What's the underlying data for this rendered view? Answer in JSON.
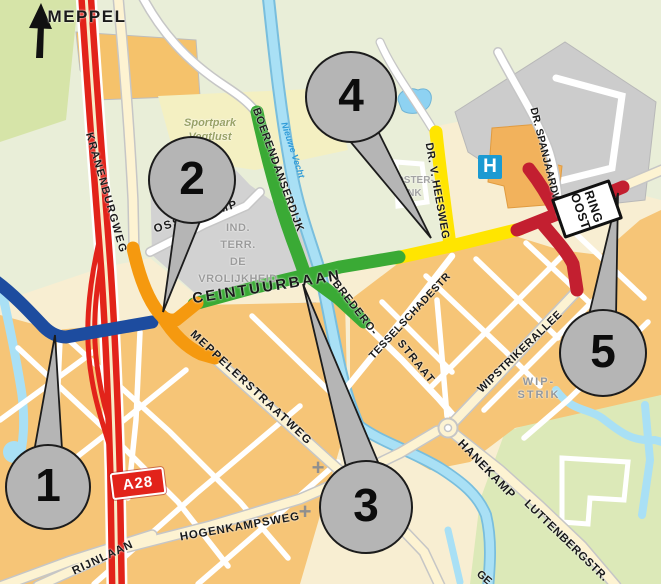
{
  "title": {
    "destination": "MEPPEL"
  },
  "street_labels": {
    "kranenburgweg": "KRANENBURGWEG",
    "ossenkamp": "OSSENKAMP",
    "boerendanserdijk": "BOERENDANSERDIJK",
    "ceintuurbaan": "CEINTUURBAAN",
    "bredero": "BREDERO-",
    "bredero_straat": "STRAAT",
    "tesselschadestr": "TESSELSCHADESTR",
    "dr_v_heesweg": "DR. V. HEESWEG",
    "dr_spanjaardweg": "DR. SPANJAARDWEG",
    "wipstrikerallee": "WIPSTRIKERALLEE",
    "meppelerstraatweg": "MEPPELERSTRAATWEG",
    "hogenkampsweg": "HOGENKAMPSWEG",
    "rijnlaan": "RIJNLAAN",
    "hanekamp": "HANEKAMP",
    "luttenbergstr": "LUTTENBERGSTR.",
    "partial_bottom": "GE"
  },
  "area_labels": {
    "sportpark_line1": "Sportpark",
    "sportpark_line2": "Vegtlust",
    "ind_terr_line1": "IND.",
    "ind_terr_line2": "TERR.",
    "ind_terr_line3": "DE",
    "ind_terr_line4": "VROLIJKHEID",
    "ooster_line1": "OOSTER-",
    "ooster_line2": "ENK",
    "wip_line1": "WIP-",
    "wip_line2": "STRIK",
    "water_nieuwe_vecht": "Nieuwe Vecht"
  },
  "badges": {
    "motorway": "A28",
    "ring_line1": "RING",
    "ring_line2": "OOST",
    "hospital": "H"
  },
  "markers": [
    {
      "number": "1"
    },
    {
      "number": "2"
    },
    {
      "number": "3"
    },
    {
      "number": "4"
    },
    {
      "number": "5"
    }
  ],
  "icons": {
    "church_cross": "+"
  },
  "colors": {
    "segment_1_blue": "#1d4c9f",
    "segment_2_orange": "#f5990f",
    "segment_3_green": "#3aaa35",
    "segment_4_yellow": "#ffe500",
    "segment_5_red": "#c31f30",
    "motorway_red": "#e2231a",
    "water_blue": "#a9e0f5",
    "hospital_blue": "#1b9ad2",
    "marker_gray": "#b5b5b5"
  }
}
